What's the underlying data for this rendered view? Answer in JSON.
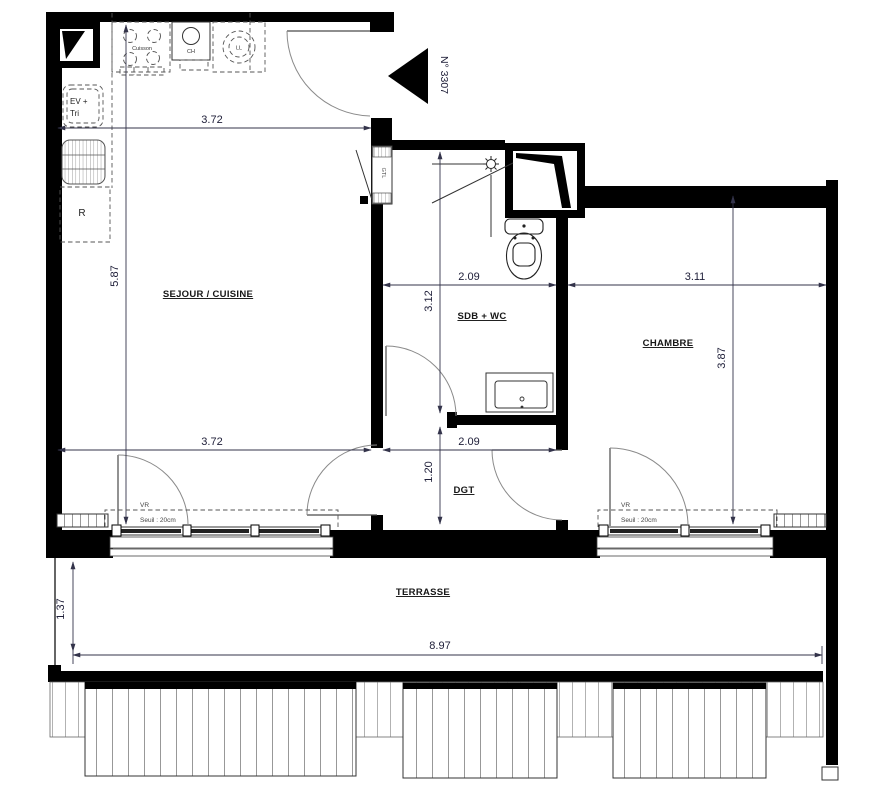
{
  "plan": {
    "unit_label": "N° 3307",
    "rooms": {
      "sejour_cuisine": "SEJOUR / CUISINE",
      "sdb_wc": "SDB + WC",
      "chambre": "CHAMBRE",
      "dgt": "DGT",
      "terrasse": "TERRASSE"
    },
    "equipment": {
      "cuisson": "Cuisson",
      "ch": "CH",
      "ll": "LL",
      "ev_line1": "EV +",
      "ev_line2": "Tri",
      "refrigerator": "R",
      "gtl": "GTL"
    },
    "dimensions": {
      "sejour_width_top": "3.72",
      "sejour_height": "5.87",
      "sejour_width_bottom": "3.72",
      "sdb_width": "2.09",
      "sdb_height": "3.12",
      "dgt_width": "2.09",
      "dgt_height": "1.20",
      "chambre_width": "3.11",
      "chambre_height": "3.87",
      "terrasse_depth": "1.37",
      "terrasse_width": "8.97"
    },
    "annotations": {
      "vr_left": "VR",
      "seuil_left": "Seuil : 20cm",
      "vr_right": "VR",
      "seuil_right": "Seuil : 20cm"
    },
    "colors": {
      "walls": "#000000",
      "dimension_text": "#20203a",
      "label_text": "#111111",
      "line_gray": "#666666"
    }
  }
}
